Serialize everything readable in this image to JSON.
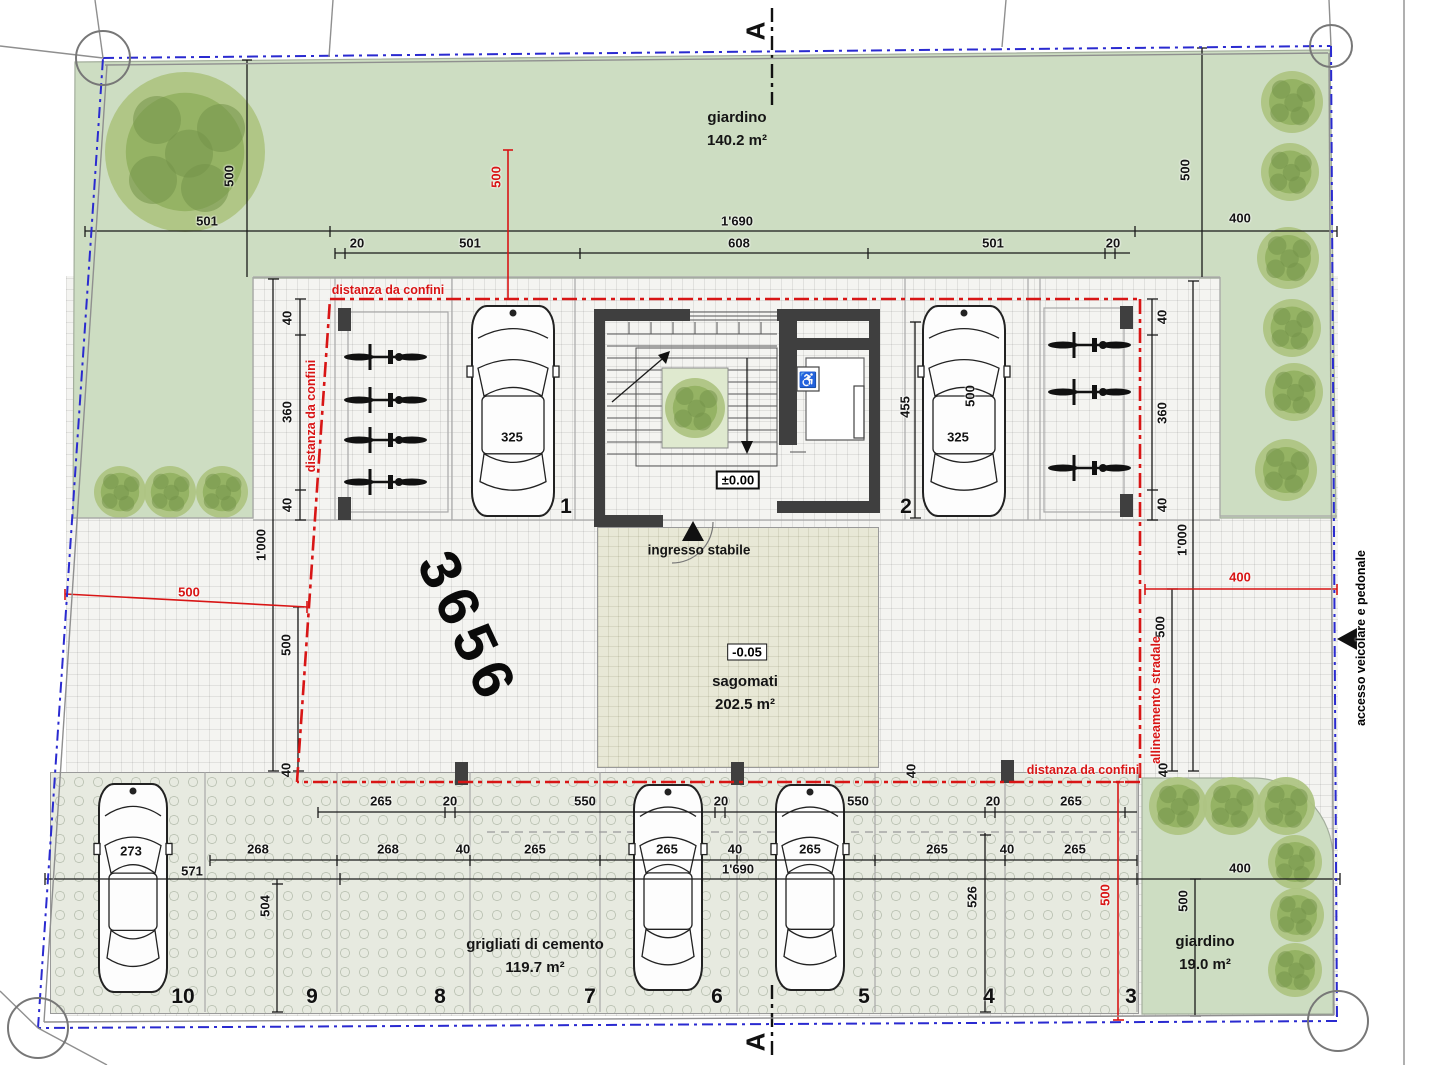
{
  "section_marker": "A",
  "parcel_number": "3656",
  "garden_top": {
    "label": "giardino",
    "area": "140.2 m²"
  },
  "garden_corner": {
    "label": "giardino",
    "area": "19.0 m²"
  },
  "grid_paving": {
    "label": "grigliati di cemento",
    "area": "119.7 m²"
  },
  "plaza": {
    "label": "sagomati",
    "area": "202.5 m²",
    "level": "-0.05"
  },
  "building": {
    "entrance_label": "ingresso stabile",
    "level": "±0.00"
  },
  "colors": {
    "garden": "#cdddc2",
    "boundary_blue": "#2a2ad0",
    "annotation_red": "#d81515",
    "wall": "#3f3f3f"
  },
  "annotations": [
    {
      "t": "distanza da confini",
      "x": 388,
      "y": 290,
      "rot": 0,
      "red": true
    },
    {
      "t": "distanza da confini",
      "x": 311,
      "y": 416,
      "rot": -90,
      "red": true
    },
    {
      "t": "distanza da confini",
      "x": 1083,
      "y": 770,
      "rot": 0,
      "red": true
    },
    {
      "t": "allineamento stradale",
      "x": 1156,
      "y": 700,
      "rot": -90,
      "red": true
    },
    {
      "t": "accesso veicolare e pedonale",
      "x": 1361,
      "y": 638,
      "rot": -90,
      "red": false
    }
  ],
  "stalls": [
    {
      "t": "1",
      "x": 566,
      "y": 507
    },
    {
      "t": "2",
      "x": 906,
      "y": 507
    },
    {
      "t": "10",
      "x": 183,
      "y": 997
    },
    {
      "t": "9",
      "x": 312,
      "y": 997
    },
    {
      "t": "8",
      "x": 440,
      "y": 997
    },
    {
      "t": "7",
      "x": 590,
      "y": 997
    },
    {
      "t": "6",
      "x": 717,
      "y": 997
    },
    {
      "t": "5",
      "x": 864,
      "y": 997
    },
    {
      "t": "4",
      "x": 989,
      "y": 997
    },
    {
      "t": "3",
      "x": 1131,
      "y": 997
    }
  ],
  "dims": [
    {
      "t": "501",
      "x": 207,
      "y": 221
    },
    {
      "t": "1'690",
      "x": 737,
      "y": 221
    },
    {
      "t": "400",
      "x": 1240,
      "y": 218
    },
    {
      "t": "20",
      "x": 357,
      "y": 243
    },
    {
      "t": "501",
      "x": 470,
      "y": 243
    },
    {
      "t": "608",
      "x": 739,
      "y": 243
    },
    {
      "t": "501",
      "x": 993,
      "y": 243
    },
    {
      "t": "20",
      "x": 1113,
      "y": 243
    },
    {
      "t": "500",
      "x": 229,
      "y": 176,
      "rot": -90
    },
    {
      "t": "500",
      "x": 496,
      "y": 177,
      "rot": -90,
      "red": true
    },
    {
      "t": "500",
      "x": 1185,
      "y": 170,
      "rot": -90
    },
    {
      "t": "40",
      "x": 287,
      "y": 318,
      "rot": -90
    },
    {
      "t": "360",
      "x": 287,
      "y": 412,
      "rot": -90
    },
    {
      "t": "40",
      "x": 287,
      "y": 505,
      "rot": -90
    },
    {
      "t": "40",
      "x": 1162,
      "y": 317,
      "rot": -90
    },
    {
      "t": "360",
      "x": 1162,
      "y": 413,
      "rot": -90
    },
    {
      "t": "40",
      "x": 1162,
      "y": 505,
      "rot": -90
    },
    {
      "t": "455",
      "x": 905,
      "y": 407,
      "rot": -90
    },
    {
      "t": "500",
      "x": 970,
      "y": 396,
      "rot": -90
    },
    {
      "t": "325",
      "x": 512,
      "y": 437
    },
    {
      "t": "325",
      "x": 958,
      "y": 437
    },
    {
      "t": "1'000",
      "x": 261,
      "y": 545,
      "rot": -90
    },
    {
      "t": "1'000",
      "x": 1182,
      "y": 540,
      "rot": -90
    },
    {
      "t": "500",
      "x": 286,
      "y": 645,
      "rot": -90
    },
    {
      "t": "500",
      "x": 1160,
      "y": 627,
      "rot": -90
    },
    {
      "t": "500",
      "x": 189,
      "y": 592,
      "red": true
    },
    {
      "t": "400",
      "x": 1240,
      "y": 577,
      "red": true
    },
    {
      "t": "40",
      "x": 286,
      "y": 770,
      "rot": -90
    },
    {
      "t": "40",
      "x": 911,
      "y": 771,
      "rot": -90
    },
    {
      "t": "40",
      "x": 1163,
      "y": 770,
      "rot": -90
    },
    {
      "t": "265",
      "x": 381,
      "y": 801
    },
    {
      "t": "20",
      "x": 450,
      "y": 801
    },
    {
      "t": "550",
      "x": 585,
      "y": 801
    },
    {
      "t": "20",
      "x": 721,
      "y": 801
    },
    {
      "t": "550",
      "x": 858,
      "y": 801
    },
    {
      "t": "20",
      "x": 993,
      "y": 801
    },
    {
      "t": "265",
      "x": 1071,
      "y": 801
    },
    {
      "t": "268",
      "x": 258,
      "y": 849
    },
    {
      "t": "268",
      "x": 388,
      "y": 849
    },
    {
      "t": "40",
      "x": 463,
      "y": 849
    },
    {
      "t": "265",
      "x": 535,
      "y": 849
    },
    {
      "t": "265",
      "x": 667,
      "y": 849
    },
    {
      "t": "40",
      "x": 735,
      "y": 849
    },
    {
      "t": "265",
      "x": 810,
      "y": 849
    },
    {
      "t": "265",
      "x": 937,
      "y": 849
    },
    {
      "t": "40",
      "x": 1007,
      "y": 849
    },
    {
      "t": "265",
      "x": 1075,
      "y": 849
    },
    {
      "t": "1'690",
      "x": 738,
      "y": 869
    },
    {
      "t": "571",
      "x": 192,
      "y": 871
    },
    {
      "t": "273",
      "x": 131,
      "y": 851
    },
    {
      "t": "504",
      "x": 265,
      "y": 906,
      "rot": -90
    },
    {
      "t": "526",
      "x": 972,
      "y": 897,
      "rot": -90
    },
    {
      "t": "400",
      "x": 1240,
      "y": 868
    },
    {
      "t": "500",
      "x": 1183,
      "y": 901,
      "rot": -90
    },
    {
      "t": "500",
      "x": 1105,
      "y": 895,
      "rot": -90,
      "red": true
    }
  ]
}
